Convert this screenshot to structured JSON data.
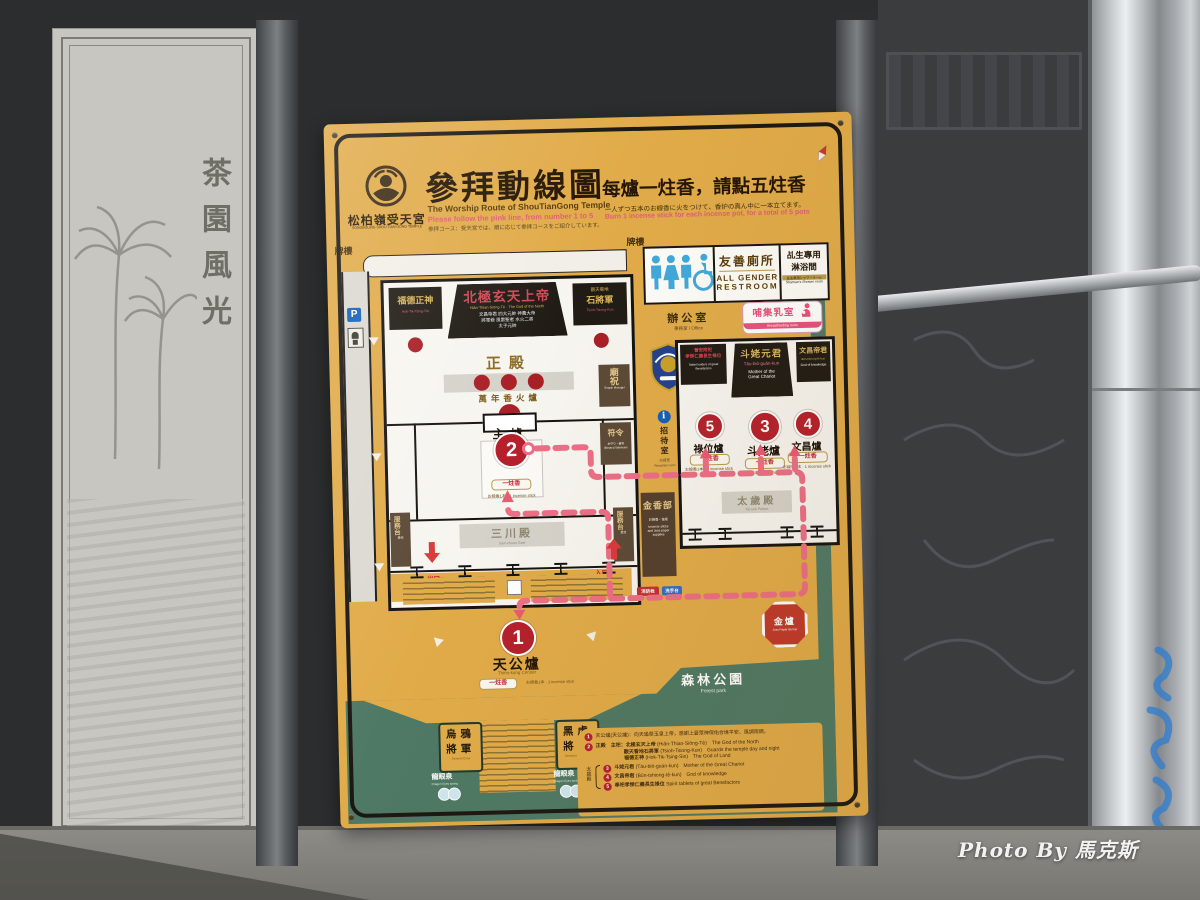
{
  "scene": {
    "watermark": "Photo By 馬克斯",
    "stone_title": "茶園風光"
  },
  "header": {
    "temple_name": "松柏嶺受天宮",
    "temple_en": "SONGBOLING SHOU TIAN GONG TEMPLE",
    "title": "參拜動線圖",
    "subtitle": "The Worship Route of ShouTianGong Temple",
    "note_en": "Please follow the pink line, from number 1 to 5",
    "note_jp": "参拝コース：受天宮では、順に応じて参拝コースをご紹介しています。",
    "rule": "每爐一炷香，請點五炷香",
    "rule_jp": "一人ずつ五本のお線香に火をつけて、香炉の真ん中に一本立てます。",
    "rule_en": "Burn 1 incense stick for each incense pot, for a total of 5 pots"
  },
  "map": {
    "gate_left": "牌樓",
    "gate_right": "牌樓",
    "parking": "P",
    "stick": "一炷香",
    "stick_note": "お線香1本 · 1 incense stick",
    "hall": {
      "left_deity": "福德正神",
      "left_deity_rom": "Hok-Tik-Tsing-Sin",
      "main_deity": "北極玄天上帝",
      "main_deity_rom": "Hiân-Thian-Siōng-Tè · The God of the North",
      "main_list1": "文昌帝君 四大元帥 神農大帝",
      "main_list2": "將軍爺 風雷聖者 水火二將",
      "main_list3": "太子元帥",
      "right_deity1": "觀天看地",
      "right_deity2": "石將軍",
      "right_deity_rom": "Tsioh-Tsiong-Kun",
      "name": "正殿",
      "eternal": "萬年香火爐",
      "keeper": "廟祝",
      "keeper_en": "Temple Manager",
      "talisman": "符令",
      "talisman_jp": "お守り・置符",
      "talisman_en": "Blessed Talismans",
      "censer_no": "2",
      "censer": "主爐",
      "gatehall": "三川殿",
      "gatehall_en": "Sam-chuan Gate",
      "service": "服務台",
      "service_jp": "受付",
      "exit": "出口",
      "exit_en": "Exit",
      "entrance": "入口",
      "entrance_en": "Entrance"
    },
    "tiangong": {
      "no": "1",
      "name": "天公爐",
      "en": "Thinn-kong Censer"
    },
    "south": {
      "crow1": "烏鴉",
      "crow2": "將軍",
      "crow_en": "General Crow",
      "tiger1": "黑虎",
      "tiger2": "將軍",
      "tiger_en": "General Black Tiger",
      "spring": "龍眼泉",
      "spring_en": "Dragon Eyes spring"
    },
    "wing": {
      "restroom": "友善廁所",
      "restroom_en1": "ALL GENDER",
      "restroom_en2": "RESTROOM",
      "shower1": "乩生專用",
      "shower2": "淋浴間",
      "shower_jp": "乩生専用シャワールーム",
      "shower_en": "Shaman's Shower room",
      "office": "辦公室",
      "office_sub": "事務室 / Office",
      "nursing": "哺集乳室",
      "nursing_en": "Breastfeeding room",
      "hdr_left1": "晉安附祀",
      "hdr_left2": "孝悌仁義長生祿位",
      "hdr_left_en": "Tablet holders of great Benefactors",
      "hdr_mid": "斗姥元君",
      "hdr_mid_rom": "Táu-bió-guán-kun",
      "hdr_mid_en1": "Mother of the",
      "hdr_mid_en2": "Great Chariot",
      "hdr_right": "文昌帝君",
      "hdr_right_rom": "Bûn-tshiong-tè-kun",
      "hdr_right_en": "God of knowledge",
      "c5_no": "5",
      "c5": "祿位爐",
      "c3_no": "3",
      "c3": "斗姥爐",
      "c4_no": "4",
      "c4": "文昌爐",
      "taisui": "太歲殿",
      "taisui_en": "Tai-suè Palace",
      "info_i": "i",
      "reception": "招待室",
      "reception_jp": "応接室",
      "reception_en": "Reception room",
      "shop": "金香部",
      "shop_jp": "お線香・金紙",
      "shop_en1": "Incense sticks",
      "shop_en2": "and Joss paper",
      "shop_en3": "supplies",
      "badge_red": "消防栓",
      "badge_blue": "洗手台",
      "burner": "金爐",
      "burner_en": "Joss Paper Burner",
      "park": "森林公園",
      "park_en": "Forest park"
    },
    "legend": {
      "n1": "1",
      "t1": "天公爐(天公爐)：向天遙祭玉皇上帝，感謝上蒼眾神保佑合境平安、風調雨順。",
      "n2": "2",
      "t2a": "正殿　主祀：北極玄天上帝",
      "t2a2": "(Hiân-Thian-Siōng-Tè)　The God of the North",
      "t2b": "觀天看地石將軍",
      "t2b2": "(Tsioh-Tsiong-Kun)　Guards the temple day and night",
      "t2c": "福德正神",
      "t2c2": "(Hok-Tik-Tsing-Sin)　The God of Land",
      "group": "太歲殿",
      "n3": "3",
      "t3": "斗姥元君",
      "t3b": "(Táu-bió-guán-kun)　Mother of the Great Chariot",
      "n4": "4",
      "t4": "文昌帝君",
      "t4b": "(Bûn-tshiong-tè-kun)　God of knowledge",
      "n5": "5",
      "t5": "奉祀孝悌仁義長生祿位",
      "t5b": "Spirit tablets of great Benefactors"
    }
  }
}
